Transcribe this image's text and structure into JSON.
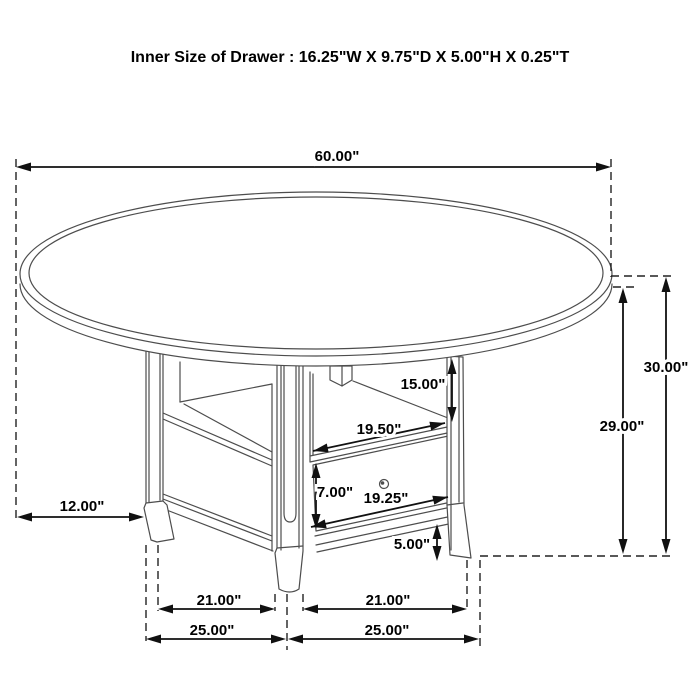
{
  "title": "Inner Size of Drawer : 16.25\"W X 9.75\"D X 5.00\"H X 0.25\"T",
  "dims": {
    "table_diameter": "60.00\"",
    "overall_height": "30.00\"",
    "underside_height": "29.00\"",
    "open_shelf_height": "15.00\"",
    "shelf_opening_width": "19.50\"",
    "drawer_front_height": "7.00\"",
    "drawer_front_width": "19.25\"",
    "base_rail_height": "5.00\"",
    "tabletop_overhang": "12.00\"",
    "leg_inner_span_left": "21.00\"",
    "leg_inner_span_right": "21.00\"",
    "base_outer_span_left": "25.00\"",
    "base_outer_span_right": "25.00\""
  },
  "colors": {
    "background": "#ffffff",
    "drawing_line": "#4d4d4d",
    "dimension_line": "#111111",
    "text": "#000000"
  }
}
